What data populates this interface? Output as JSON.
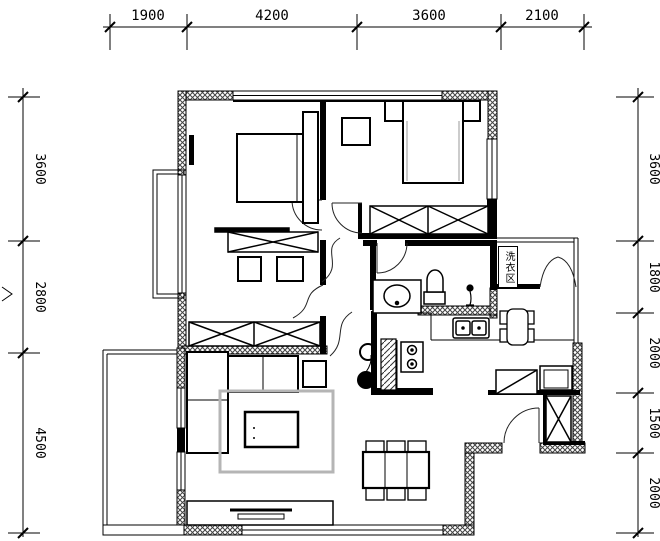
{
  "dimensions": {
    "top": [
      "1900",
      "4200",
      "3600",
      "2100"
    ],
    "left": [
      "3600",
      "2800",
      "4500"
    ],
    "right": [
      "3600",
      "1800",
      "2000",
      "1500",
      "2000"
    ]
  },
  "labels": {
    "laundry": "洗衣区"
  },
  "colors": {
    "line": "#000000",
    "hatch": "#444444",
    "rug": "#b5b5b5",
    "background": "#ffffff"
  }
}
